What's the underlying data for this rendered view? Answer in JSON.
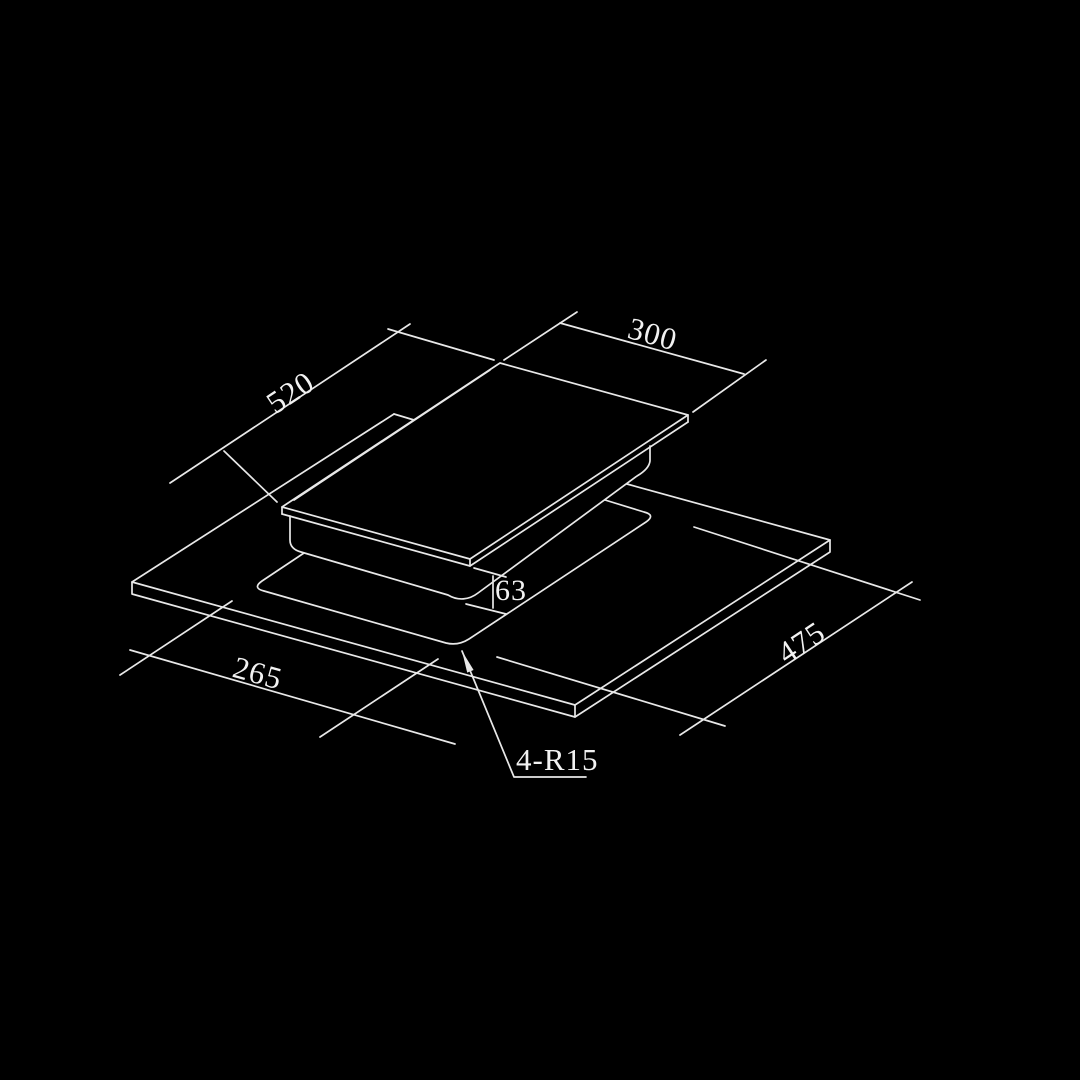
{
  "drawing": {
    "title": "Domino hob installation cutout drawing",
    "background_color": "#000000",
    "line_color": "#e8e8e8",
    "text_color": "#f2f2f2",
    "labels": {
      "hob_width": "300",
      "hob_depth": "520",
      "hob_body_height": "63",
      "cutout_depth": "475",
      "cutout_width": "265",
      "corner_radius": "4-R15"
    }
  }
}
